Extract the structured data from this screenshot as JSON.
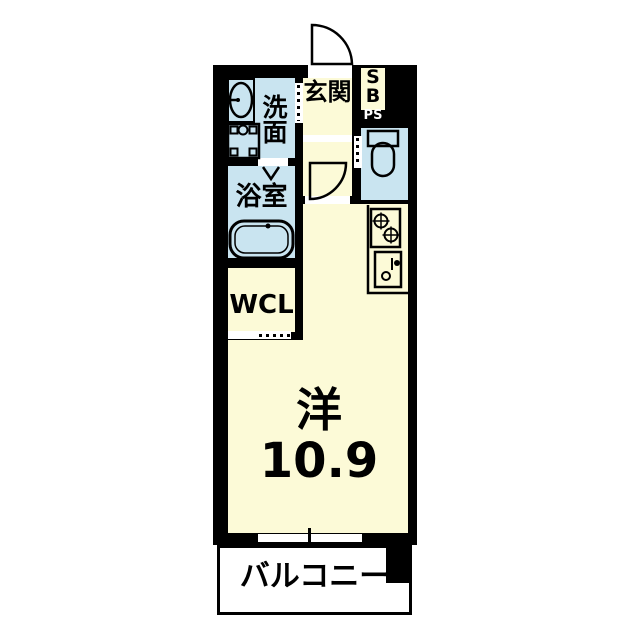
{
  "plan": {
    "type": "floor-plan",
    "colors": {
      "wall": "#000000",
      "room_floor": "#fcfad7",
      "wet_area_floor": "#c9e4f0",
      "balcony": "#ffffff"
    },
    "rooms": {
      "entrance": {
        "label": "玄関"
      },
      "shoe_box": {
        "label_top": "S",
        "label_bottom": "B"
      },
      "pipe_space": {
        "label": "PS"
      },
      "washroom": {
        "label": "洗面"
      },
      "bathroom": {
        "label": "浴室"
      },
      "toilet": {
        "label": ""
      },
      "walk_in_closet": {
        "label": "WCL"
      },
      "main_room": {
        "label": "洋",
        "size": "10.9"
      },
      "balcony": {
        "label": "バルコニー"
      }
    }
  }
}
